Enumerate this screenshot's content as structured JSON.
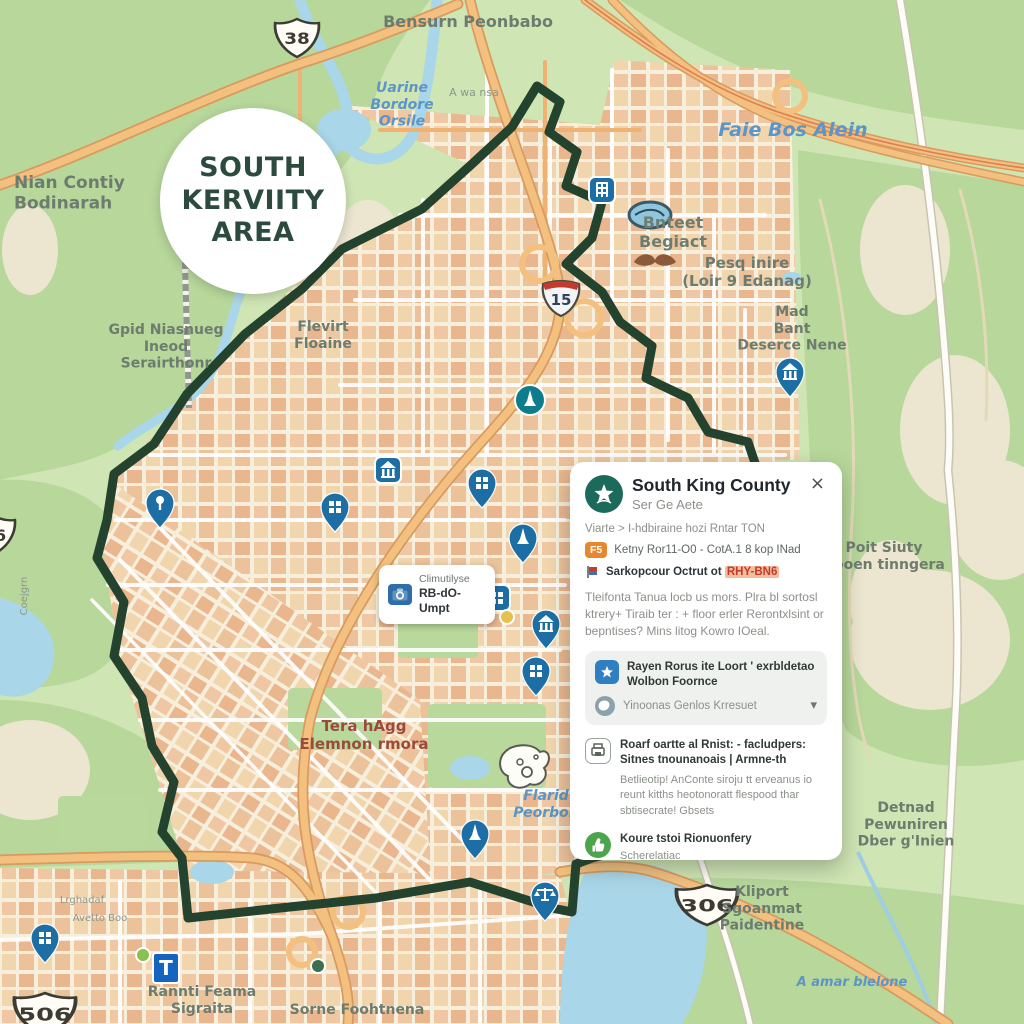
{
  "map": {
    "badge": {
      "lines": [
        "SOUTH",
        "KERVIITY",
        "AREA"
      ]
    },
    "info_label": {
      "line1": "Climutilyse",
      "line2": "RB-dO-Umpt"
    },
    "shields": [
      {
        "type": "us",
        "label": "38",
        "x": 297,
        "y": 38,
        "sx": 1.15,
        "sy": 1.0
      },
      {
        "type": "i",
        "label": "15",
        "x": 561,
        "y": 296,
        "sx": 1.0,
        "sy": 1.0
      },
      {
        "type": "us",
        "label": "306",
        "x": 707,
        "y": 905,
        "sx": 1.6,
        "sy": 1.05
      },
      {
        "type": "us",
        "label": "506",
        "x": 45,
        "y": 1014,
        "sx": 1.6,
        "sy": 1.1
      },
      {
        "type": "us",
        "label": "06",
        "x": -6,
        "y": 535,
        "sx": 1.1,
        "sy": 1.0
      }
    ],
    "labels": [
      {
        "lines": [
          "Bensurn Peonbabo"
        ],
        "x": 468,
        "y": 27,
        "kind": "place",
        "size": 16
      },
      {
        "lines": [
          "Nian Contiy",
          "Bodinarah"
        ],
        "x": 14,
        "y": 188,
        "kind": "place",
        "size": 17,
        "anchor": "start"
      },
      {
        "lines": [
          "Uarine",
          "Bordore",
          "Orsile"
        ],
        "x": 402,
        "y": 92,
        "kind": "water",
        "size": 14
      },
      {
        "lines": [
          "A wa nsa"
        ],
        "x": 474,
        "y": 96,
        "kind": "minor",
        "size": 11
      },
      {
        "lines": [
          "Faie Bos Alein"
        ],
        "x": 793,
        "y": 136,
        "kind": "water",
        "size": 19
      },
      {
        "lines": [
          "Bnteet",
          "Begiact"
        ],
        "x": 673,
        "y": 228,
        "kind": "place",
        "size": 16
      },
      {
        "lines": [
          "Pesq inire",
          "(Loir 9 Edanag)"
        ],
        "x": 747,
        "y": 268,
        "kind": "place",
        "size": 15
      },
      {
        "lines": [
          "Mad",
          "Bant",
          "Deserce Nene"
        ],
        "x": 792,
        "y": 316,
        "kind": "place",
        "size": 14
      },
      {
        "lines": [
          "Gpid Niasnueg",
          "Ineod",
          "Serairthonr"
        ],
        "x": 166,
        "y": 334,
        "kind": "place",
        "size": 14
      },
      {
        "lines": [
          "Flevirt",
          "Floaine"
        ],
        "x": 323,
        "y": 331,
        "kind": "place",
        "size": 14
      },
      {
        "lines": [
          "Poit Siuty",
          "Rooen tinngera"
        ],
        "x": 884,
        "y": 552,
        "kind": "place",
        "size": 14
      },
      {
        "lines": [
          "Tera hAgg",
          "Elemnon rmora"
        ],
        "x": 364,
        "y": 731,
        "kind": "district",
        "size": 15
      },
      {
        "lines": [
          "Flarid",
          "Peorbon"
        ],
        "x": 546,
        "y": 800,
        "kind": "water",
        "size": 14
      },
      {
        "lines": [
          "Detnad",
          "Pewuniren",
          "Dber g'Inien"
        ],
        "x": 906,
        "y": 812,
        "kind": "place",
        "size": 14
      },
      {
        "lines": [
          "Kliport",
          "Sgoanmat",
          "Paidentine"
        ],
        "x": 762,
        "y": 896,
        "kind": "place",
        "size": 14
      },
      {
        "lines": [
          "Rannti Feama",
          "Sigraita"
        ],
        "x": 202,
        "y": 996,
        "kind": "place",
        "size": 14
      },
      {
        "lines": [
          "Sorne Foohtnena"
        ],
        "x": 357,
        "y": 1014,
        "kind": "place",
        "size": 14
      },
      {
        "lines": [
          "A amar blelone"
        ],
        "x": 852,
        "y": 986,
        "kind": "water",
        "size": 13
      },
      {
        "lines": [
          "Lrghadaf"
        ],
        "x": 82,
        "y": 903,
        "kind": "minor",
        "size": 10
      },
      {
        "lines": [
          "Avetto Boo"
        ],
        "x": 100,
        "y": 921,
        "kind": "minor",
        "size": 10
      },
      {
        "lines": [
          "Coejgrn"
        ],
        "x": 27,
        "y": 596,
        "kind": "minor",
        "size": 10,
        "rotate": -90
      }
    ],
    "pins": [
      {
        "x": 602,
        "y": 190,
        "shape": "square",
        "glyph": "building",
        "color": "#1c6ea4"
      },
      {
        "x": 790,
        "y": 381,
        "shape": "drop",
        "glyph": "bank",
        "color": "#1c6ea4"
      },
      {
        "x": 530,
        "y": 400,
        "shape": "circle",
        "glyph": "monument",
        "color": "#0f7c8c"
      },
      {
        "x": 388,
        "y": 470,
        "shape": "square",
        "glyph": "bank",
        "color": "#1c6ea4"
      },
      {
        "x": 482,
        "y": 492,
        "shape": "drop",
        "glyph": "grid",
        "color": "#1c6ea4"
      },
      {
        "x": 335,
        "y": 516,
        "shape": "drop",
        "glyph": "grid",
        "color": "#1c6ea4"
      },
      {
        "x": 160,
        "y": 512,
        "shape": "drop",
        "glyph": "pin",
        "color": "#1c6ea4"
      },
      {
        "x": 523,
        "y": 547,
        "shape": "drop",
        "glyph": "monument",
        "color": "#1c6ea4"
      },
      {
        "x": 497,
        "y": 598,
        "shape": "square",
        "glyph": "grid",
        "color": "#1c6ea4"
      },
      {
        "x": 546,
        "y": 633,
        "shape": "drop",
        "glyph": "bank",
        "color": "#1c6ea4"
      },
      {
        "x": 507,
        "y": 617,
        "shape": "dot",
        "color": "#e3c24d"
      },
      {
        "x": 536,
        "y": 680,
        "shape": "drop",
        "glyph": "grid",
        "color": "#1c6ea4"
      },
      {
        "x": 475,
        "y": 843,
        "shape": "drop",
        "glyph": "monument",
        "color": "#1c6ea4"
      },
      {
        "x": 545,
        "y": 905,
        "shape": "drop",
        "glyph": "scales",
        "color": "#1c6ea4"
      },
      {
        "x": 45,
        "y": 947,
        "shape": "drop",
        "glyph": "grid",
        "color": "#1c6ea4"
      },
      {
        "x": 166,
        "y": 968,
        "shape": "sign",
        "glyph": "T",
        "color": "#1565c0"
      },
      {
        "x": 143,
        "y": 955,
        "shape": "dot",
        "color": "#8bbf4e"
      },
      {
        "x": 318,
        "y": 966,
        "shape": "dot",
        "color": "#3c6e4f"
      }
    ],
    "colors": {
      "boundary": "#23432f",
      "pin_blue": "#1c6ea4",
      "pin_teal": "#0f7c8c",
      "highway": "#f3c07f",
      "water": "#a9d6e8",
      "forest": "#b7d79b",
      "urban_bg": "#f7efdc",
      "accent_teal": "#1b6a5a",
      "badge_text": "#2d4a3e",
      "highlight_bg": "#f5bd9c",
      "highlight_text": "#c23b2e"
    }
  },
  "panel": {
    "title": "South King County",
    "subtitle": "Ser Ge Aete",
    "close_glyph": "×",
    "meta_line": "Viarte > I-hdbiraine hozi Rntar TON",
    "route_badge": "F5",
    "route_text": "Ketny Ror11-O0 - CotA.1 8 kop INad",
    "district_label": "Sarkopcour Octrut ot",
    "district_code": "RHY-BN6",
    "description": "Tleifonta Tanua locb us mors. Plra bl sortosl ktrery+ Tiraib ter : + floor erler Rerontxlsint or bepntises? Mins litog Kowro IOeal.",
    "selector_title": "Rayen Rorus ite Loort ' exrbldetao Wolbon Foornce",
    "selector_value": "Yinoonas Genlos Krresuet",
    "chevron_glyph": "▾",
    "section2_title": "Roarf oartte al Rnist: - facludpers: Sitnes tnounanoais | Armne-th",
    "section2_body": "Betlieotip! AnConte siroju tt erveanus io reunt kitths heotonoratt flespood thar sbtisecrate! Gbsets",
    "section3_title": "Koure tstoi Rionuonfery",
    "section3_sub": "Scherelatiac"
  }
}
